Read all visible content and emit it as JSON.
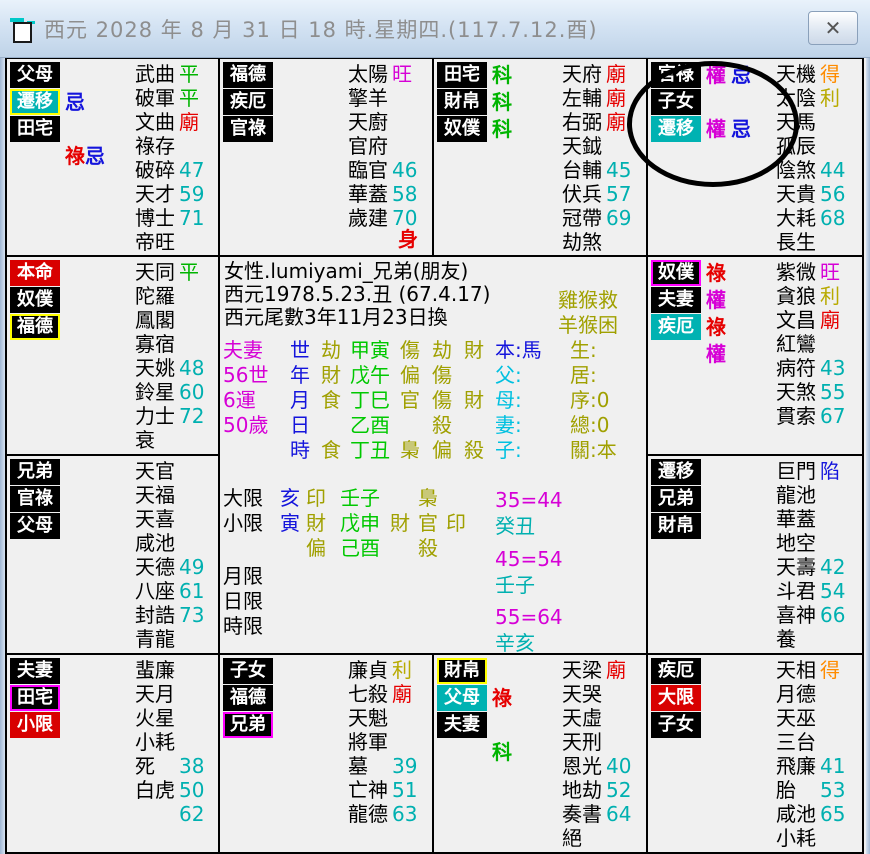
{
  "titlebar": {
    "title": "西元 2028 年 8 月 31 日 18 時.星期四.(117.7.12.酉)",
    "close_glyph": "✕"
  },
  "colors": {
    "black": "#000000",
    "green": "#00b400",
    "brightGreen": "#00c800",
    "red": "#e60000",
    "magenta": "#d600d6",
    "orange": "#ff8c00",
    "yellow": "#b8aa00",
    "olive": "#a0a000",
    "cyanNum": "#00b0b0",
    "cyanText": "#00c0e0",
    "blue": "#1414dc"
  },
  "palaces": [
    {
      "id": "parents",
      "row": 1,
      "col": 1,
      "labels": [
        {
          "text": "父母",
          "bg": "black"
        },
        {
          "text": "遷移",
          "bg": "cyan",
          "border": "yellow",
          "marks": [
            {
              "t": "忌",
              "c": "blue"
            }
          ]
        },
        {
          "text": "田宅",
          "bg": "black"
        }
      ],
      "extra_marks": [
        {
          "t": "祿",
          "c": "red"
        },
        {
          "t": "忌",
          "c": "blue"
        }
      ],
      "stars": [
        {
          "n": "武曲",
          "v": "平",
          "c": "green"
        },
        {
          "n": "破軍",
          "v": "平",
          "c": "green"
        },
        {
          "n": "文曲",
          "v": "廟",
          "c": "red"
        },
        {
          "n": "祿存"
        },
        {
          "n": "破碎",
          "v": "47",
          "c": "cyanNum"
        },
        {
          "n": "天才",
          "v": "59",
          "c": "cyanNum"
        },
        {
          "n": "博士",
          "v": "71",
          "c": "cyanNum"
        },
        {
          "n": "帝旺"
        }
      ]
    },
    {
      "id": "fortune",
      "row": 1,
      "col": 2,
      "labels": [
        {
          "text": "福德",
          "bg": "black"
        },
        {
          "text": "疾厄",
          "bg": "black"
        },
        {
          "text": "官祿",
          "bg": "black"
        }
      ],
      "corner": {
        "t": "身",
        "c": "red"
      },
      "stars": [
        {
          "n": "太陽",
          "v": "旺",
          "c": "magenta"
        },
        {
          "n": "擎羊"
        },
        {
          "n": "天廚"
        },
        {
          "n": "官府"
        },
        {
          "n": "臨官",
          "v": "46",
          "c": "cyanNum"
        },
        {
          "n": "華蓋",
          "v": "58",
          "c": "cyanNum"
        },
        {
          "n": "歲建",
          "v": "70",
          "c": "cyanNum"
        }
      ]
    },
    {
      "id": "property",
      "row": 1,
      "col": 3,
      "labels": [
        {
          "text": "田宅",
          "bg": "black",
          "marks": [
            {
              "t": "科",
              "c": "green"
            }
          ]
        },
        {
          "text": "財帛",
          "bg": "black",
          "marks": [
            {
              "t": "科",
              "c": "green"
            }
          ]
        },
        {
          "text": "奴僕",
          "bg": "black",
          "marks": [
            {
              "t": "科",
              "c": "green"
            }
          ]
        }
      ],
      "stars": [
        {
          "n": "天府",
          "v": "廟",
          "c": "red"
        },
        {
          "n": "左輔",
          "v": "廟",
          "c": "red"
        },
        {
          "n": "右弼",
          "v": "廟",
          "c": "red"
        },
        {
          "n": "天鉞"
        },
        {
          "n": "台輔",
          "v": "45",
          "c": "cyanNum"
        },
        {
          "n": "伏兵",
          "v": "57",
          "c": "cyanNum"
        },
        {
          "n": "冠帶",
          "v": "69",
          "c": "cyanNum"
        },
        {
          "n": "劫煞"
        }
      ]
    },
    {
      "id": "career",
      "row": 1,
      "col": 4,
      "labels": [
        {
          "text": "官祿",
          "bg": "black",
          "marks": [
            {
              "t": "權",
              "c": "magenta"
            },
            {
              "t": "忌",
              "c": "blue"
            }
          ]
        },
        {
          "text": "子女",
          "bg": "black"
        },
        {
          "text": "遷移",
          "bg": "cyan",
          "marks": [
            {
              "t": "權",
              "c": "magenta"
            },
            {
              "t": "忌",
              "c": "blue"
            }
          ]
        }
      ],
      "stars": [
        {
          "n": "天機",
          "v": "得",
          "c": "orange"
        },
        {
          "n": "太陰",
          "v": "利",
          "c": "yellow"
        },
        {
          "n": "天馬"
        },
        {
          "n": "孤辰"
        },
        {
          "n": "陰煞",
          "v": "44",
          "c": "cyanNum"
        },
        {
          "n": "天貴",
          "v": "56",
          "c": "cyanNum"
        },
        {
          "n": "大耗",
          "v": "68",
          "c": "cyanNum"
        },
        {
          "n": "長生"
        }
      ]
    },
    {
      "id": "self",
      "row": 2,
      "col": 1,
      "labels": [
        {
          "text": "本命",
          "bg": "red"
        },
        {
          "text": "奴僕",
          "bg": "black"
        },
        {
          "text": "福德",
          "bg": "black",
          "border": "yellow"
        }
      ],
      "stars": [
        {
          "n": "天同",
          "v": "平",
          "c": "green"
        },
        {
          "n": "陀羅"
        },
        {
          "n": "鳳閣"
        },
        {
          "n": "寡宿"
        },
        {
          "n": "天姚",
          "v": "48",
          "c": "cyanNum"
        },
        {
          "n": "鈴星",
          "v": "60",
          "c": "cyanNum"
        },
        {
          "n": "力士",
          "v": "72",
          "c": "cyanNum"
        },
        {
          "n": "衰"
        }
      ]
    },
    {
      "id": "servants",
      "row": 2,
      "col": 4,
      "labels": [
        {
          "text": "奴僕",
          "bg": "black",
          "border": "magenta",
          "marks": [
            {
              "t": "祿",
              "c": "red"
            }
          ]
        },
        {
          "text": "夫妻",
          "bg": "black",
          "marks": [
            {
              "t": "權",
              "c": "magenta"
            }
          ]
        },
        {
          "text": "疾厄",
          "bg": "cyan",
          "marks": [
            {
              "t": "祿",
              "c": "red"
            }
          ]
        }
      ],
      "extra_marks": [
        {
          "t": "權",
          "c": "magenta"
        }
      ],
      "stars": [
        {
          "n": "紫微",
          "v": "旺",
          "c": "magenta"
        },
        {
          "n": "貪狼",
          "v": "利",
          "c": "yellow"
        },
        {
          "n": "文昌",
          "v": "廟",
          "c": "red"
        },
        {
          "n": "紅鸞"
        },
        {
          "n": "病符",
          "v": "43",
          "c": "cyanNum"
        },
        {
          "n": "天煞",
          "v": "55",
          "c": "cyanNum"
        },
        {
          "n": "貫索",
          "v": "67",
          "c": "cyanNum"
        }
      ]
    },
    {
      "id": "siblings",
      "row": 3,
      "col": 1,
      "labels": [
        {
          "text": "兄弟",
          "bg": "black"
        },
        {
          "text": "官祿",
          "bg": "black"
        },
        {
          "text": "父母",
          "bg": "black"
        }
      ],
      "stars": [
        {
          "n": "天官"
        },
        {
          "n": "天福"
        },
        {
          "n": "天喜"
        },
        {
          "n": "咸池"
        },
        {
          "n": "天德",
          "v": "49",
          "c": "cyanNum"
        },
        {
          "n": "八座",
          "v": "61",
          "c": "cyanNum"
        },
        {
          "n": "封誥",
          "v": "73",
          "c": "cyanNum"
        },
        {
          "n": "青龍"
        }
      ]
    },
    {
      "id": "travel",
      "row": 3,
      "col": 4,
      "labels": [
        {
          "text": "遷移",
          "bg": "black"
        },
        {
          "text": "兄弟",
          "bg": "black"
        },
        {
          "text": "財帛",
          "bg": "black"
        }
      ],
      "stars": [
        {
          "n": "巨門",
          "v": "陷",
          "c": "blue"
        },
        {
          "n": "龍池"
        },
        {
          "n": "華蓋"
        },
        {
          "n": "地空"
        },
        {
          "n": "天壽",
          "v": "42",
          "c": "cyanNum"
        },
        {
          "n": "斗君",
          "v": "54",
          "c": "cyanNum"
        },
        {
          "n": "喜神",
          "v": "66",
          "c": "cyanNum"
        },
        {
          "n": "養"
        }
      ]
    },
    {
      "id": "spouse",
      "row": 4,
      "col": 1,
      "labels": [
        {
          "text": "夫妻",
          "bg": "black"
        },
        {
          "text": "田宅",
          "bg": "black",
          "border": "magenta"
        },
        {
          "text": "小限",
          "bg": "red"
        }
      ],
      "stars": [
        {
          "n": "蜚廉"
        },
        {
          "n": "天月"
        },
        {
          "n": "火星"
        },
        {
          "n": "小耗"
        },
        {
          "n": "死",
          "v": "38",
          "c": "cyanNum"
        },
        {
          "n": "白虎",
          "v": "50",
          "c": "cyanNum"
        },
        {
          "n": "",
          "v": "62",
          "c": "cyanNum"
        }
      ]
    },
    {
      "id": "children",
      "row": 4,
      "col": 2,
      "labels": [
        {
          "text": "子女",
          "bg": "black"
        },
        {
          "text": "福德",
          "bg": "black"
        },
        {
          "text": "兄弟",
          "bg": "black",
          "border": "magenta"
        }
      ],
      "stars": [
        {
          "n": "廉貞",
          "v": "利",
          "c": "yellow"
        },
        {
          "n": "七殺",
          "v": "廟",
          "c": "red"
        },
        {
          "n": "天魁"
        },
        {
          "n": "將軍"
        },
        {
          "n": "墓",
          "v": "39",
          "c": "cyanNum"
        },
        {
          "n": "亡神",
          "v": "51",
          "c": "cyanNum"
        },
        {
          "n": "龍德",
          "v": "63",
          "c": "cyanNum"
        }
      ]
    },
    {
      "id": "wealth",
      "row": 4,
      "col": 3,
      "labels": [
        {
          "text": "財帛",
          "bg": "black",
          "border": "yellow"
        },
        {
          "text": "父母",
          "bg": "cyan",
          "marks": [
            {
              "t": "祿",
              "c": "red"
            }
          ]
        },
        {
          "text": "夫妻",
          "bg": "black"
        }
      ],
      "extra_marks": [
        {
          "t": "科",
          "c": "green"
        }
      ],
      "stars": [
        {
          "n": "天梁",
          "v": "廟",
          "c": "red"
        },
        {
          "n": "天哭"
        },
        {
          "n": "天虛"
        },
        {
          "n": "天刑"
        },
        {
          "n": "恩光",
          "v": "40",
          "c": "cyanNum"
        },
        {
          "n": "地劫",
          "v": "52",
          "c": "cyanNum"
        },
        {
          "n": "奏書",
          "v": "64",
          "c": "cyanNum"
        },
        {
          "n": "絕"
        }
      ]
    },
    {
      "id": "health",
      "row": 4,
      "col": 4,
      "labels": [
        {
          "text": "疾厄",
          "bg": "black"
        },
        {
          "text": "大限",
          "bg": "red"
        },
        {
          "text": "子女",
          "bg": "black"
        }
      ],
      "stars": [
        {
          "n": "天相",
          "v": "得",
          "c": "orange"
        },
        {
          "n": "月德"
        },
        {
          "n": "天巫"
        },
        {
          "n": "三台"
        },
        {
          "n": "飛廉",
          "v": "41",
          "c": "cyanNum"
        },
        {
          "n": "胎",
          "v": "53",
          "c": "cyanNum"
        },
        {
          "n": "咸池",
          "v": "65",
          "c": "cyanNum"
        },
        {
          "n": "小耗"
        }
      ]
    }
  ],
  "center": {
    "info_lines": [
      "女性.lumiyami_兄弟(朋友)",
      "西元1978.5.23.丑 (67.4.17)",
      "西元尾數3年11月23日換"
    ],
    "pillar_rows": [
      {
        "stage": "夫妻",
        "branch": "世",
        "tgod": "劫",
        "pillar": "甲寅",
        "slots": [
          "傷",
          "劫",
          "財"
        ],
        "fam": "本:馬",
        "fam_c": "blue"
      },
      {
        "stage": "56世",
        "branch": "年",
        "tgod": "財",
        "pillar": "戊午",
        "slots": [
          "偏",
          "傷",
          ""
        ],
        "fam": "父:",
        "fam_c": "cyanText"
      },
      {
        "stage": "6運",
        "branch": "月",
        "tgod": "食",
        "pillar": "丁巳",
        "slots": [
          "官",
          "傷",
          "財"
        ],
        "fam": "母:",
        "fam_c": "cyanText"
      },
      {
        "stage": "50歲",
        "branch": "日",
        "tgod": "",
        "pillar": "乙酉",
        "slots": [
          "",
          "殺",
          ""
        ],
        "fam": "妻:",
        "fam_c": "cyanText"
      },
      {
        "stage": "",
        "branch": "時",
        "tgod": "食",
        "pillar": "丁丑",
        "slots": [
          "梟",
          "偏",
          "殺"
        ],
        "fam": "子:",
        "fam_c": "cyanText"
      }
    ],
    "fate_lines": [
      "雞猴救",
      "羊猴困",
      "生:",
      "居:",
      "序:0",
      "總:0",
      "關:本"
    ],
    "limit_rows": [
      {
        "label": "大限",
        "branch": "亥",
        "tgod": "印",
        "pillar": "壬子",
        "slots": [
          "",
          "梟",
          ""
        ]
      },
      {
        "label": "小限",
        "branch": "寅",
        "tgod": "財",
        "pillar": "戊申",
        "slots": [
          "財",
          "官",
          "印"
        ]
      },
      {
        "label": "",
        "branch": "",
        "tgod": "偏",
        "pillar": "己酉",
        "slots": [
          "",
          "殺",
          ""
        ]
      },
      {
        "label": "月限",
        "branch": "",
        "tgod": "",
        "pillar": "",
        "slots": [
          "",
          "",
          ""
        ]
      },
      {
        "label": "日限",
        "branch": "",
        "tgod": "",
        "pillar": "",
        "slots": [
          "",
          "",
          ""
        ]
      },
      {
        "label": "時限",
        "branch": "",
        "tgod": "",
        "pillar": "",
        "slots": [
          "",
          "",
          ""
        ]
      }
    ],
    "decades": [
      {
        "range": "35=44",
        "pillar": "癸丑"
      },
      {
        "range": "45=54",
        "pillar": "壬子"
      },
      {
        "range": "55=64",
        "pillar": "辛亥"
      }
    ]
  },
  "annotation": {
    "shape": "ellipse"
  }
}
